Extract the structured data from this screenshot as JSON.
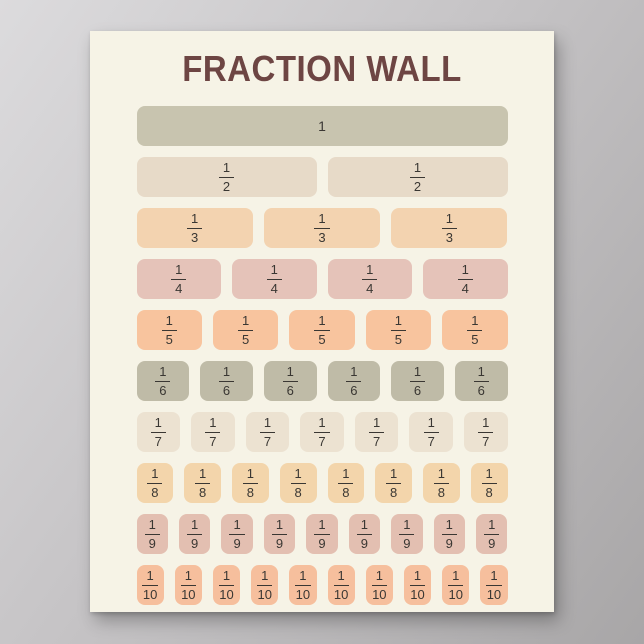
{
  "background": {
    "top_left_color": "#dcdbdd",
    "bottom_right_color": "#a8a6a7"
  },
  "poster": {
    "title": "FRACTION WALL",
    "title_color": "#6d4543",
    "paper_color": "#f6f3e6",
    "fraction_text_color": "#3a3733",
    "rows": [
      {
        "name": "whole",
        "pieces": 1,
        "numerator": "1",
        "denominator": "",
        "color": "#c8c4af"
      },
      {
        "name": "halves",
        "pieces": 2,
        "numerator": "1",
        "denominator": "2",
        "color": "#e7dac8"
      },
      {
        "name": "thirds",
        "pieces": 3,
        "numerator": "1",
        "denominator": "3",
        "color": "#f3d3b0"
      },
      {
        "name": "quarters",
        "pieces": 4,
        "numerator": "1",
        "denominator": "4",
        "color": "#e5c3b9"
      },
      {
        "name": "fifths",
        "pieces": 5,
        "numerator": "1",
        "denominator": "5",
        "color": "#f8c49e"
      },
      {
        "name": "sixths",
        "pieces": 6,
        "numerator": "1",
        "denominator": "6",
        "color": "#bfbba7"
      },
      {
        "name": "sevenths",
        "pieces": 7,
        "numerator": "1",
        "denominator": "7",
        "color": "#ece2d1"
      },
      {
        "name": "eighths",
        "pieces": 8,
        "numerator": "1",
        "denominator": "8",
        "color": "#f3d5ab"
      },
      {
        "name": "ninths",
        "pieces": 9,
        "numerator": "1",
        "denominator": "9",
        "color": "#e3bfb1"
      },
      {
        "name": "tenths",
        "pieces": 10,
        "numerator": "1",
        "denominator": "10",
        "color": "#f6bf9d"
      }
    ]
  }
}
